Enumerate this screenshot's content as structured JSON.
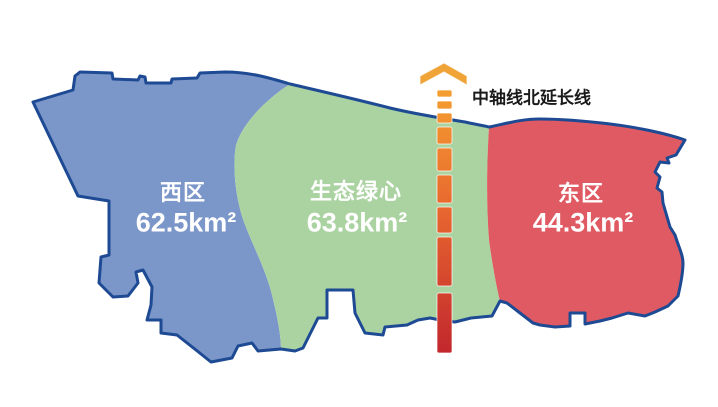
{
  "map": {
    "outline_color": "#1E4A94",
    "background_color": "#FFFFFF",
    "label_text_color": "#FFFFFF",
    "axis_label_color": "#1A1A1A"
  },
  "regions": [
    {
      "name": "西区",
      "area_label": "62.5km²",
      "fill": "#7B96C9"
    },
    {
      "name": "生态绿心",
      "area_label": "63.8km²",
      "fill": "#ABD3A2"
    },
    {
      "name": "东区",
      "area_label": "44.3km²",
      "fill": "#E05A63"
    }
  ],
  "axis": {
    "label": "中轴线北延长线",
    "arrow_color": "#F0A438",
    "gradient_top": "#F5A030",
    "gradient_mid": "#E8682F",
    "gradient_bottom": "#C2272D"
  }
}
